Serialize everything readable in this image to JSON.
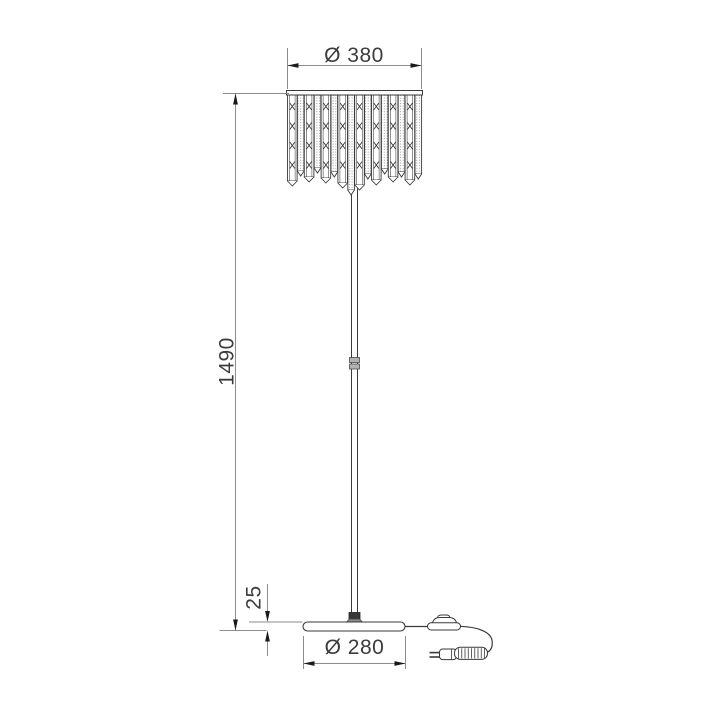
{
  "page": {
    "background": "#ffffff",
    "colors": {
      "outline": "#3a3a3a",
      "dim_line": "#8c8c8c",
      "arrow": "#1a1a1a",
      "text": "#3c3c3c",
      "metal_light": "#b3b3b3",
      "metal_dark": "#383838",
      "socket_gray": "#909090",
      "stipple_dot": "#8f8f8f"
    }
  },
  "diagram": {
    "type": "technical-dimension-drawing",
    "subject": "floor lamp with crystal strip shade, front elevation",
    "dimensions": {
      "shade_diameter": {
        "label": "Ø 380",
        "value": 380
      },
      "total_height": {
        "label": "1490",
        "value": 1490
      },
      "base_thickness": {
        "label": "25",
        "value": 25
      },
      "base_diameter": {
        "label": "Ø 280",
        "value": 280
      }
    },
    "shade": {
      "left": 287.5,
      "hang_y": 95,
      "gap": 0.3,
      "tip": 5
    },
    "shade_strips": [
      {
        "type": "x",
        "w": 9.6,
        "bottom": 181
      },
      {
        "type": "dot",
        "w": 6.6,
        "bottom": 171
      },
      {
        "type": "x",
        "w": 9.6,
        "bottom": 177
      },
      {
        "type": "dot",
        "w": 6.6,
        "bottom": 168
      },
      {
        "type": "x",
        "w": 9.6,
        "bottom": 178
      },
      {
        "type": "dot",
        "w": 6.6,
        "bottom": 172
      },
      {
        "type": "x",
        "w": 9.6,
        "bottom": 183
      },
      {
        "type": "dot",
        "w": 6.6,
        "bottom": 190
      },
      {
        "type": "x",
        "w": 9.6,
        "bottom": 185
      },
      {
        "type": "dot",
        "w": 6.6,
        "bottom": 174
      },
      {
        "type": "x",
        "w": 9.6,
        "bottom": 180
      },
      {
        "type": "dot",
        "w": 6.6,
        "bottom": 169
      },
      {
        "type": "x",
        "w": 9.6,
        "bottom": 177
      },
      {
        "type": "dot",
        "w": 6.6,
        "bottom": 172
      },
      {
        "type": "x",
        "w": 9.6,
        "bottom": 180
      },
      {
        "type": "dot",
        "w": 6.6,
        "bottom": 174
      }
    ]
  }
}
